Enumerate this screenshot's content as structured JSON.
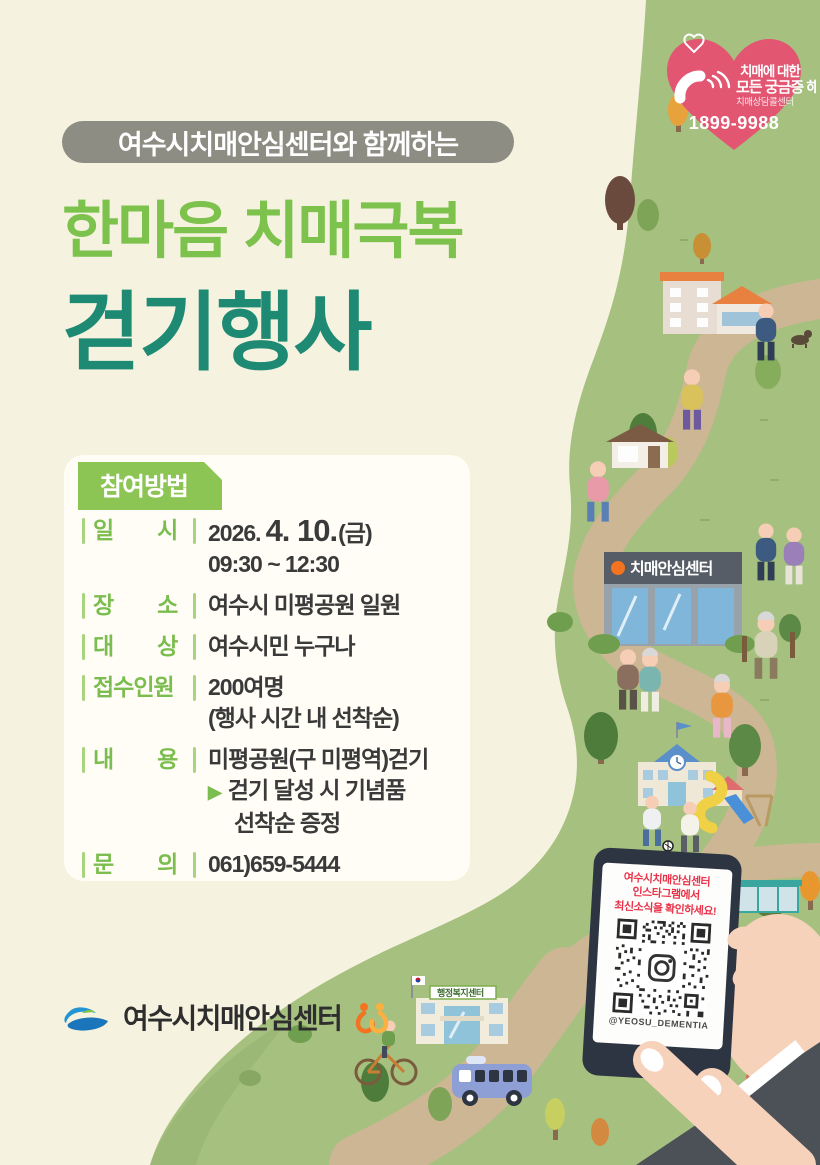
{
  "colors": {
    "background": "#f6f2e0",
    "grass_green": "#a5c07f",
    "trail_tan": "#cdb694",
    "title_light_green": "#7cc24d",
    "title_teal": "#1f8a73",
    "label_green": "#7bbd4e",
    "section_badge_green": "#8cc553",
    "heart_pink": "#e25672",
    "body_text_dark": "#3a3a3a",
    "notice_red": "#e8334a",
    "pill_gray": "#8d8d83"
  },
  "heart_badge": {
    "line1": "치매에 대한",
    "line2": "모든 궁금증 해결",
    "line3": "치매상담콜센터",
    "phone_number": "1899-9988"
  },
  "header": {
    "pill_label": "여수시치매안심센터와 함께하는",
    "title_line1": "한마음 치매극복",
    "title_line2": "걷기행사"
  },
  "info_box": {
    "section_title": "참여방법",
    "rows": [
      {
        "label": "일　　시",
        "value1": "2026.",
        "value_big": "4. 10.",
        "value2": "(금)",
        "line2": "09:30 ~ 12:30"
      },
      {
        "label": "장　　소",
        "value": "여수시 미평공원 일원"
      },
      {
        "label": "대　　상",
        "value": "여수시민 누구나"
      },
      {
        "label": "접수인원",
        "value": "200여명",
        "line2": "(행사 시간 내 선착순)"
      },
      {
        "label": "내　　용",
        "value": "미평공원(구 미평역)걷기",
        "bullet": "▶",
        "line2": "걷기 달성 시 기념품",
        "line3": "선착순 증정"
      },
      {
        "label": "문　　의",
        "value": "061)659-5444"
      }
    ]
  },
  "illustration": {
    "center_sign": "치매안심센터",
    "welfare_sign": "행정복지센터"
  },
  "phone": {
    "notice_line1": "여수시치매안심센터",
    "notice_line2": "인스타그램에서",
    "notice_line3": "최신소식을 확인하세요!",
    "instagram_handle": "@YEOSU_DEMENTIA"
  },
  "footer": {
    "org_name": "여수시치매안심센터"
  }
}
